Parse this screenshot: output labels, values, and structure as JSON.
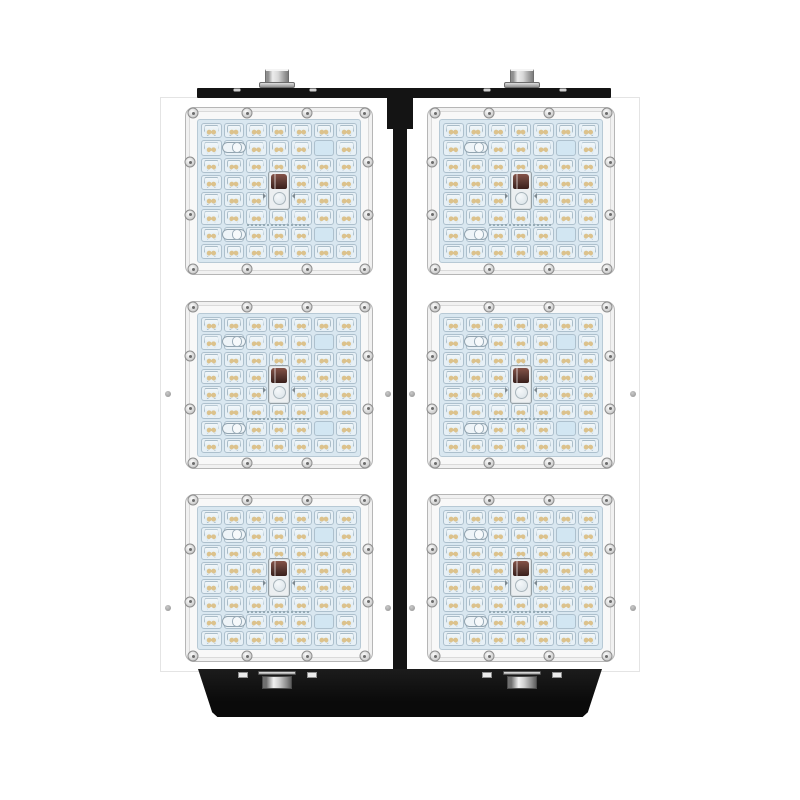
{
  "meta": {
    "type": "product-photo",
    "subject": "Modular LED flood light luminaire, front view, six square LED modules on a white body with black mounting brackets",
    "background_color": "#ffffff"
  },
  "fixture": {
    "layout": {
      "columns": 2,
      "rows": 3
    },
    "module_count": 6,
    "modules": [
      {
        "id": "module-1",
        "row": 1,
        "column": 1
      },
      {
        "id": "module-2",
        "row": 1,
        "column": 2
      },
      {
        "id": "module-3",
        "row": 2,
        "column": 1
      },
      {
        "id": "module-4",
        "row": 2,
        "column": 2
      },
      {
        "id": "module-5",
        "row": 3,
        "column": 1
      },
      {
        "id": "module-6",
        "row": 3,
        "column": 2
      }
    ],
    "module_spec": {
      "led_grid": {
        "columns": 7,
        "rows": 8
      },
      "cell_positions": 56,
      "led_lens_count": 50,
      "pill_connector_cells": [
        {
          "row": 2,
          "col": 2
        },
        {
          "row": 7,
          "col": 2
        }
      ],
      "blank_cells": [
        {
          "row": 2,
          "col": 6
        },
        {
          "row": 7,
          "col": 6
        }
      ],
      "center_sensor": {
        "col": 4,
        "rows": [
          4,
          5
        ]
      },
      "perimeter_screws": 12,
      "print_line": true
    },
    "mounting": {
      "top_bar": {
        "bolts": 2,
        "face_screws": 4
      },
      "bottom_bracket": {
        "bolts": 2,
        "studs": 4,
        "shape": "trapezoid"
      },
      "center_divider": true,
      "body_screws": 8
    },
    "colors": {
      "body": "#ffffff",
      "frame": "#f8f8f8",
      "frame_border": "#b6b6b6",
      "panel": "#d9e7f0",
      "cell": "#e7f0f6",
      "cell_border": "#adc0cd",
      "blank": "#d2e6f2",
      "led_amber": "#dcc28c",
      "pill": "#eef4f8",
      "sensor_dark": "#5d3a33",
      "sensor_frame": "#eceff1",
      "black": "#141414"
    }
  }
}
